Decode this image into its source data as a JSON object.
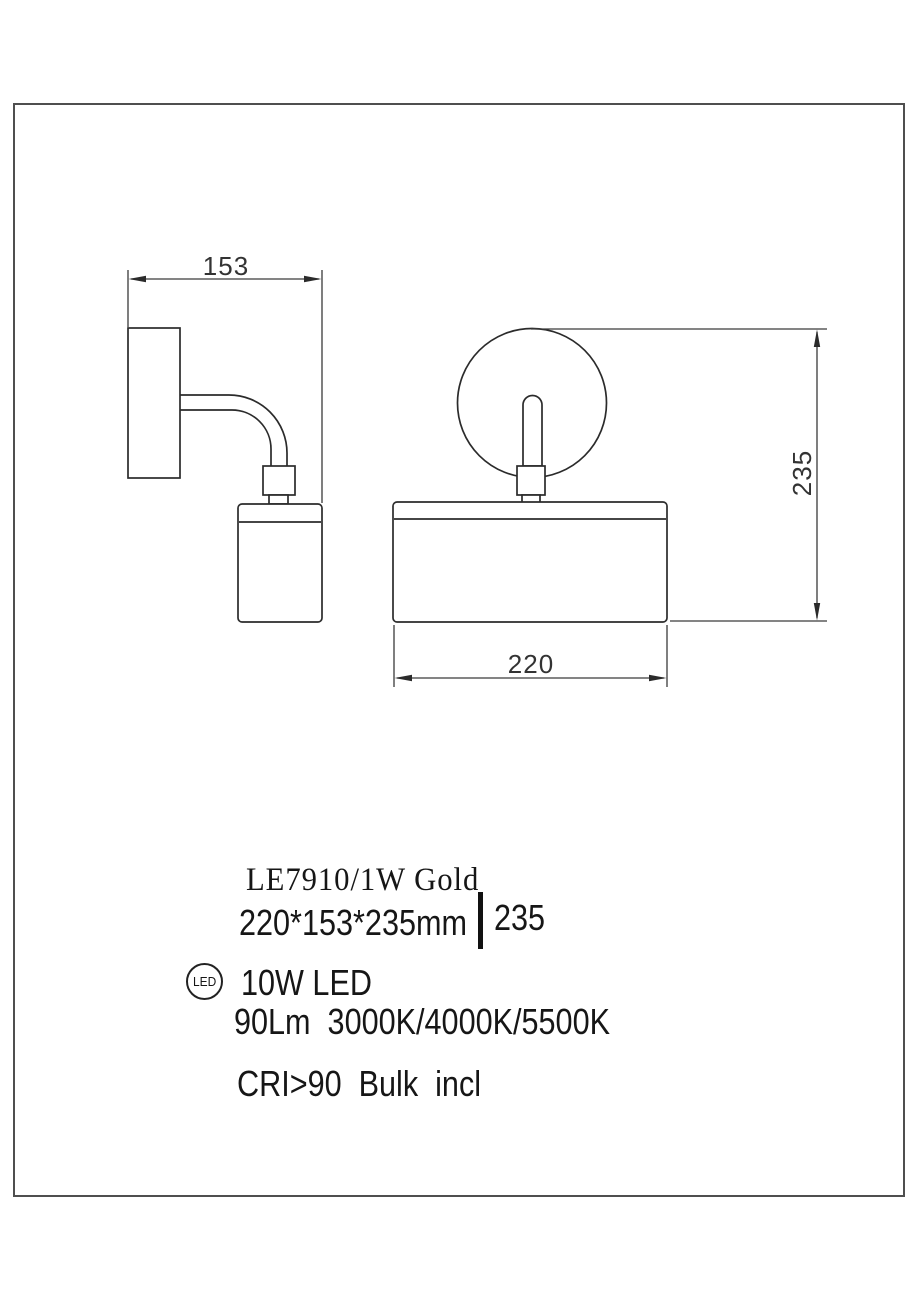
{
  "drawing": {
    "dimensions": {
      "depth": "153",
      "height": "235",
      "width": "220"
    }
  },
  "specs": {
    "model": "LE7910/1W Gold",
    "size": "220*153*235mm",
    "height_value": "235",
    "led_badge": "LED",
    "power": "10W LED",
    "output": "90Lm  3000K/4000K/5500K",
    "cri": "CRI>90  Bulk  incl"
  },
  "colors": {
    "line": "#2b2b2b",
    "dimension_line": "#3a3a3a",
    "text": "#161616",
    "frame_border": "#4f4f4f",
    "background": "#ffffff"
  }
}
